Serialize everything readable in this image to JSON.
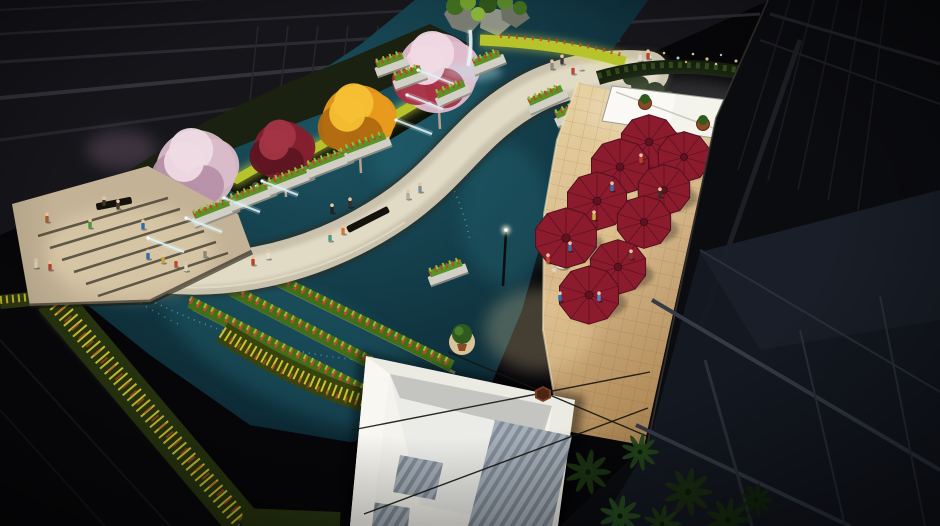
{
  "scene": {
    "description": "Night-time aerial 3D architectural rendering of a courtyard garden: teal water feature with planter boxes, a curved stone walkway with pedestrians, a terrace of autumn trees over a lit hedge, a stepped plaza, a tiled cafe patio with dark-red umbrellas and tables, a glowing skylight, a sunken white stairwell, all framed by dark glass building facades",
    "colors": {
      "bg": "#060609",
      "facade": "#15151a",
      "facadeLine": "#26262d",
      "rightWall": "#0b0c10",
      "roofPanel": "#161a23",
      "roofFrame": "#343a46",
      "water": "#123641",
      "waterDeep": "#0b2630",
      "sparkle": "#7fd4de",
      "walkway": "#c9c1ac",
      "walkwayLight": "#e8e1cb",
      "plaza": "#c3b295",
      "stepLine": "#4a4336",
      "hedge": "#b6c32b",
      "hedgeGlow": "#dbe24a",
      "fascia": "#e5e2d6",
      "patioLight": "#efe3c0",
      "umbrella": "#8c1b2e",
      "umbrellaRib": "#51101e",
      "table": "#e9e6db",
      "chair": "#d9d5c9",
      "skylight": "#f4f3ec",
      "stairWall": "#ecebe3",
      "stairTread": "#a2abb4",
      "flowerYellow": "#d6c92f",
      "flowerRed": "#bb4a2c",
      "plantGreen": "#5a9427",
      "plantLight": "#8cc437",
      "skin": "#e6c6a2",
      "pot": "#8a4a26",
      "benchDark": "#14120a",
      "cable": "#15150f"
    },
    "trees": [
      {
        "x": 196,
        "y": 170,
        "r": 40,
        "c1": "#d9bcca",
        "c2": "#b690a8",
        "c3": "#eedbe4"
      },
      {
        "x": 283,
        "y": 151,
        "r": 30,
        "c1": "#83202e",
        "c2": "#5d1522",
        "c3": "#a23545"
      },
      {
        "x": 358,
        "y": 121,
        "r": 36,
        "c1": "#e89a1d",
        "c2": "#b06a10",
        "c3": "#f6c035"
      },
      {
        "x": 437,
        "y": 73,
        "r": 40,
        "c1": "#e0bccd",
        "c2": "#a72f45",
        "c3": "#f0dae4"
      }
    ],
    "umbrellas": [
      {
        "x": 649,
        "y": 142,
        "r": 29
      },
      {
        "x": 684,
        "y": 157,
        "r": 27
      },
      {
        "x": 620,
        "y": 167,
        "r": 30
      },
      {
        "x": 664,
        "y": 190,
        "r": 27
      },
      {
        "x": 597,
        "y": 201,
        "r": 31
      },
      {
        "x": 644,
        "y": 222,
        "r": 28
      },
      {
        "x": 566,
        "y": 238,
        "r": 32
      },
      {
        "x": 618,
        "y": 267,
        "r": 29
      },
      {
        "x": 589,
        "y": 295,
        "r": 31
      }
    ],
    "tables": [
      {
        "x": 633,
        "y": 157
      },
      {
        "x": 606,
        "y": 187
      },
      {
        "x": 651,
        "y": 206
      },
      {
        "x": 581,
        "y": 224
      },
      {
        "x": 627,
        "y": 252
      },
      {
        "x": 562,
        "y": 265
      },
      {
        "x": 603,
        "y": 288
      },
      {
        "x": 668,
        "y": 172
      },
      {
        "x": 586,
        "y": 207
      },
      {
        "x": 645,
        "y": 130
      }
    ],
    "chairs": [
      {
        "x": 624,
        "y": 162,
        "rot": 20
      },
      {
        "x": 642,
        "y": 151,
        "rot": -30
      },
      {
        "x": 598,
        "y": 192,
        "rot": 40
      },
      {
        "x": 615,
        "y": 181,
        "rot": -15
      },
      {
        "x": 659,
        "y": 211,
        "rot": 10
      },
      {
        "x": 573,
        "y": 229,
        "rot": 25
      },
      {
        "x": 590,
        "y": 218,
        "rot": -35
      },
      {
        "x": 635,
        "y": 257,
        "rot": 15
      },
      {
        "x": 554,
        "y": 270,
        "rot": 30
      },
      {
        "x": 571,
        "y": 259,
        "rot": -20
      },
      {
        "x": 611,
        "y": 293,
        "rot": 12
      },
      {
        "x": 595,
        "y": 283,
        "rot": -40
      },
      {
        "x": 676,
        "y": 177,
        "rot": 18
      },
      {
        "x": 652,
        "y": 135,
        "rot": -25
      }
    ],
    "people": [
      {
        "x": 36,
        "y": 267,
        "c": "#d8d0c0"
      },
      {
        "x": 50,
        "y": 269,
        "c": "#b8422e"
      },
      {
        "x": 47,
        "y": 221,
        "c": "#a65a2e"
      },
      {
        "x": 90,
        "y": 227,
        "c": "#3f9b35"
      },
      {
        "x": 104,
        "y": 205,
        "c": "#40322a"
      },
      {
        "x": 118,
        "y": 208,
        "c": "#4a3a2e"
      },
      {
        "x": 143,
        "y": 228,
        "c": "#2a6eae"
      },
      {
        "x": 148,
        "y": 258,
        "c": "#2a6eae"
      },
      {
        "x": 163,
        "y": 262,
        "c": "#c9a23a"
      },
      {
        "x": 176,
        "y": 266,
        "c": "#b84a3a"
      },
      {
        "x": 186,
        "y": 270,
        "c": "#d8d4c8"
      },
      {
        "x": 205,
        "y": 256,
        "c": "#8a8678"
      },
      {
        "x": 253,
        "y": 264,
        "c": "#b5442a"
      },
      {
        "x": 268,
        "y": 258,
        "c": "#e4e0d4"
      },
      {
        "x": 330,
        "y": 240,
        "c": "#4a9a8e"
      },
      {
        "x": 343,
        "y": 233,
        "c": "#d8763a"
      },
      {
        "x": 332,
        "y": 212,
        "c": "#23201a"
      },
      {
        "x": 350,
        "y": 206,
        "c": "#35302a"
      },
      {
        "x": 408,
        "y": 198,
        "c": "#b0aca0"
      },
      {
        "x": 420,
        "y": 191,
        "c": "#7a8e9e"
      },
      {
        "x": 552,
        "y": 68,
        "c": "#8e8a7e"
      },
      {
        "x": 562,
        "y": 63,
        "c": "#3a3a3a"
      },
      {
        "x": 573,
        "y": 73,
        "c": "#b84a3a"
      },
      {
        "x": 581,
        "y": 69,
        "c": "#d8d4c8"
      },
      {
        "x": 640,
        "y": 60,
        "c": "#e0dcd0"
      },
      {
        "x": 648,
        "y": 58,
        "c": "#b8442e"
      },
      {
        "x": 641,
        "y": 162,
        "c": "#b5442a"
      },
      {
        "x": 612,
        "y": 190,
        "c": "#3a6ea8"
      },
      {
        "x": 594,
        "y": 219,
        "c": "#c9b23a"
      },
      {
        "x": 570,
        "y": 250,
        "c": "#3a6ea8"
      },
      {
        "x": 631,
        "y": 258,
        "c": "#7a3a2a"
      },
      {
        "x": 599,
        "y": 300,
        "c": "#4a84c4"
      },
      {
        "x": 548,
        "y": 262,
        "c": "#c04438"
      },
      {
        "x": 660,
        "y": 196,
        "c": "#33302a"
      },
      {
        "x": 560,
        "y": 300,
        "c": "#2a6eae"
      }
    ],
    "planters": [
      {
        "x": 215,
        "y": 212,
        "rot": -21,
        "len": 48
      },
      {
        "x": 252,
        "y": 196,
        "rot": -21,
        "len": 48
      },
      {
        "x": 290,
        "y": 180,
        "rot": -21,
        "len": 48
      },
      {
        "x": 329,
        "y": 163,
        "rot": -21,
        "len": 48
      },
      {
        "x": 367,
        "y": 147,
        "rot": -21,
        "len": 48
      },
      {
        "x": 391,
        "y": 64,
        "rot": -20,
        "len": 34
      },
      {
        "x": 409,
        "y": 77,
        "rot": -20,
        "len": 34
      },
      {
        "x": 452,
        "y": 93,
        "rot": -24,
        "len": 36
      },
      {
        "x": 547,
        "y": 99,
        "rot": -24,
        "len": 42
      },
      {
        "x": 574,
        "y": 112,
        "rot": -24,
        "len": 42
      },
      {
        "x": 601,
        "y": 125,
        "rot": -24,
        "len": 42
      },
      {
        "x": 447,
        "y": 272,
        "rot": -20,
        "len": 40
      },
      {
        "x": 488,
        "y": 62,
        "rot": -22,
        "len": 34
      }
    ],
    "plant_rows": [
      {
        "x1": 190,
        "y1": 302,
        "x2": 378,
        "y2": 398
      },
      {
        "x1": 228,
        "y1": 288,
        "x2": 420,
        "y2": 388
      },
      {
        "x1": 266,
        "y1": 274,
        "x2": 452,
        "y2": 366
      }
    ],
    "jets": [
      {
        "x": 148,
        "y": 238
      },
      {
        "x": 186,
        "y": 218
      },
      {
        "x": 224,
        "y": 198
      },
      {
        "x": 262,
        "y": 181
      },
      {
        "x": 418,
        "y": 70
      },
      {
        "x": 407,
        "y": 95
      },
      {
        "x": 396,
        "y": 120
      }
    ],
    "wall_lights": [
      {
        "x": 210,
        "y": 206
      },
      {
        "x": 256,
        "y": 186
      },
      {
        "x": 300,
        "y": 166
      },
      {
        "x": 346,
        "y": 146
      },
      {
        "x": 388,
        "y": 128
      },
      {
        "x": 160,
        "y": 230
      },
      {
        "x": 428,
        "y": 64
      }
    ],
    "bokeh": [
      {
        "x": 650,
        "y": 57,
        "r": 1.6,
        "c": "#f5e6b2"
      },
      {
        "x": 664,
        "y": 53,
        "r": 1.3,
        "c": "#ffd98a"
      },
      {
        "x": 678,
        "y": 58,
        "r": 1.5,
        "c": "#cfe4f5"
      },
      {
        "x": 693,
        "y": 54,
        "r": 1.3,
        "c": "#f5e6b2"
      },
      {
        "x": 707,
        "y": 59,
        "r": 1.6,
        "c": "#ffd98a"
      },
      {
        "x": 721,
        "y": 55,
        "r": 1.2,
        "c": "#cfe4f5"
      },
      {
        "x": 736,
        "y": 61,
        "r": 1.5,
        "c": "#f5e6b2"
      },
      {
        "x": 750,
        "y": 57,
        "r": 1.3,
        "c": "#ffd98a"
      },
      {
        "x": 764,
        "y": 63,
        "r": 1.6,
        "c": "#cfe4f5"
      },
      {
        "x": 778,
        "y": 60,
        "r": 1.2,
        "c": "#f5e6b2"
      },
      {
        "x": 686,
        "y": 62,
        "r": 1.1,
        "c": "#ffd98a"
      },
      {
        "x": 716,
        "y": 64,
        "r": 1.2,
        "c": "#f5e6b2"
      }
    ],
    "palms": [
      {
        "x": 588,
        "y": 472,
        "s": 1.2,
        "c": "#1c3512"
      },
      {
        "x": 640,
        "y": 452,
        "s": 1.0,
        "c": "#24461a"
      },
      {
        "x": 688,
        "y": 492,
        "s": 1.3,
        "c": "#1a3010"
      },
      {
        "x": 620,
        "y": 516,
        "s": 1.1,
        "c": "#275020"
      },
      {
        "x": 728,
        "y": 520,
        "s": 1.2,
        "c": "#18300f"
      },
      {
        "x": 662,
        "y": 524,
        "s": 1.0,
        "c": "#203c14"
      },
      {
        "x": 756,
        "y": 500,
        "s": 0.9,
        "c": "#142a0c"
      }
    ],
    "pots": [
      {
        "x": 645,
        "y": 103
      },
      {
        "x": 703,
        "y": 124
      }
    ],
    "benches": [
      {
        "x": 96,
        "y": 200,
        "w": 36,
        "rot": -11
      },
      {
        "x": 345,
        "y": 216,
        "w": 46,
        "rot": -27
      }
    ]
  }
}
